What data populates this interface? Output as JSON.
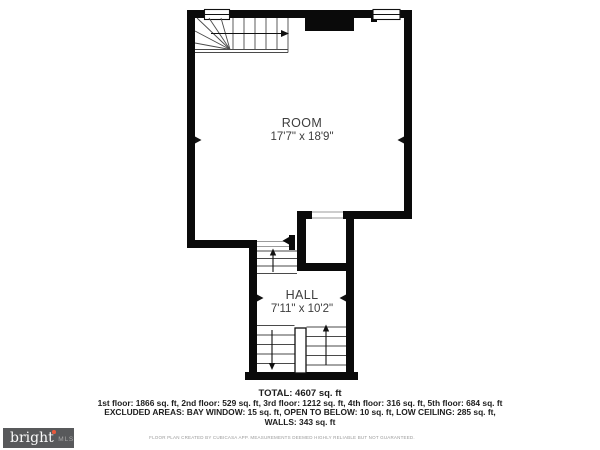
{
  "plan": {
    "rooms": [
      {
        "name": "ROOM",
        "dims": "17'7\" x 18'9\""
      },
      {
        "name": "HALL",
        "dims": "7'11\" x 10'2\""
      }
    ],
    "summary": {
      "total": "TOTAL: 4607 sq. ft",
      "floors": "1st floor: 1866 sq. ft, 2nd floor: 529 sq. ft, 3rd floor: 1212 sq. ft, 4th floor: 316 sq. ft, 5th floor: 684 sq. ft",
      "excluded": "EXCLUDED AREAS: BAY WINDOW: 15 sq. ft, OPEN TO BELOW: 10 sq. ft, LOW CEILING: 285 sq. ft,",
      "walls": "WALLS: 343 sq. ft"
    },
    "disclaimer": "FLOOR PLAN CREATED BY CUBICASA APP. MEASUREMENTS DEEMED HIGHLY RELIABLE BUT NOT GUARANTEED.",
    "logo": {
      "brand": "bright",
      "suffix": "MLS"
    },
    "colors": {
      "wall": "#0a0a0a",
      "stair_line": "#4a4a4a",
      "logo_bg": "#58595b",
      "logo_accent": "#e8593c"
    }
  }
}
